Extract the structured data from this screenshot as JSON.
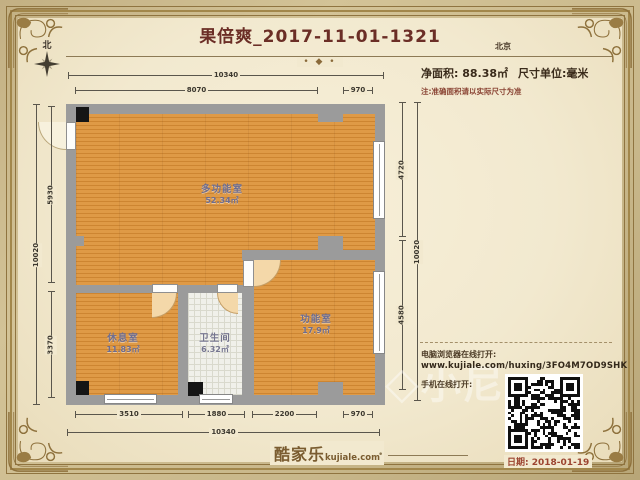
{
  "header": {
    "title": "果倍爽_2017-11-01-1321",
    "city": "北京",
    "north": "北",
    "area_label": "净面积: 88.38㎡",
    "unit_label": "尺寸单位:毫米",
    "note": "注:准确面积请以实际尺寸为准"
  },
  "rooms": [
    {
      "name": "多功能室",
      "area": "52.34㎡"
    },
    {
      "name": "休息室",
      "area": "11.83㎡"
    },
    {
      "name": "卫生间",
      "area": "6.32㎡"
    },
    {
      "name": "功能室",
      "area": "17.9㎡"
    }
  ],
  "dims": {
    "top_outer": "10340",
    "top_inner": [
      "8070",
      "970"
    ],
    "bottom_inner": [
      "3510",
      "1880",
      "2200",
      "970"
    ],
    "bottom_outer": "10340",
    "left_outer": "10020",
    "left_inner": [
      "5930",
      "3370"
    ],
    "right_inner": [
      "4720",
      "4580"
    ],
    "right_outer": "10020"
  },
  "share": {
    "desktop_label": "电脑浏览器在线打开:",
    "url": "www.kujiale.com/huxing/3FO4M7OD9SHK",
    "mobile_label": "手机在线打开:"
  },
  "footer": {
    "brand": "酷家乐",
    "brand_domain": "kujiale.com",
    "date": "日期: 2018-01-19"
  },
  "watermark": {
    "icon": "◇",
    "text": "小尼"
  },
  "icons": {
    "divider_ornament": "• ◆ •"
  },
  "colors": {
    "floor_wood": "#d89140",
    "wall": "#9b9b9b",
    "bathroom_tile": "#f0f0ea",
    "title_text": "#6b2e26",
    "note_red": "#8a4434",
    "date_red": "#9c4430",
    "frame_gold": "#a2874b",
    "paper": "#f2e9cf"
  }
}
